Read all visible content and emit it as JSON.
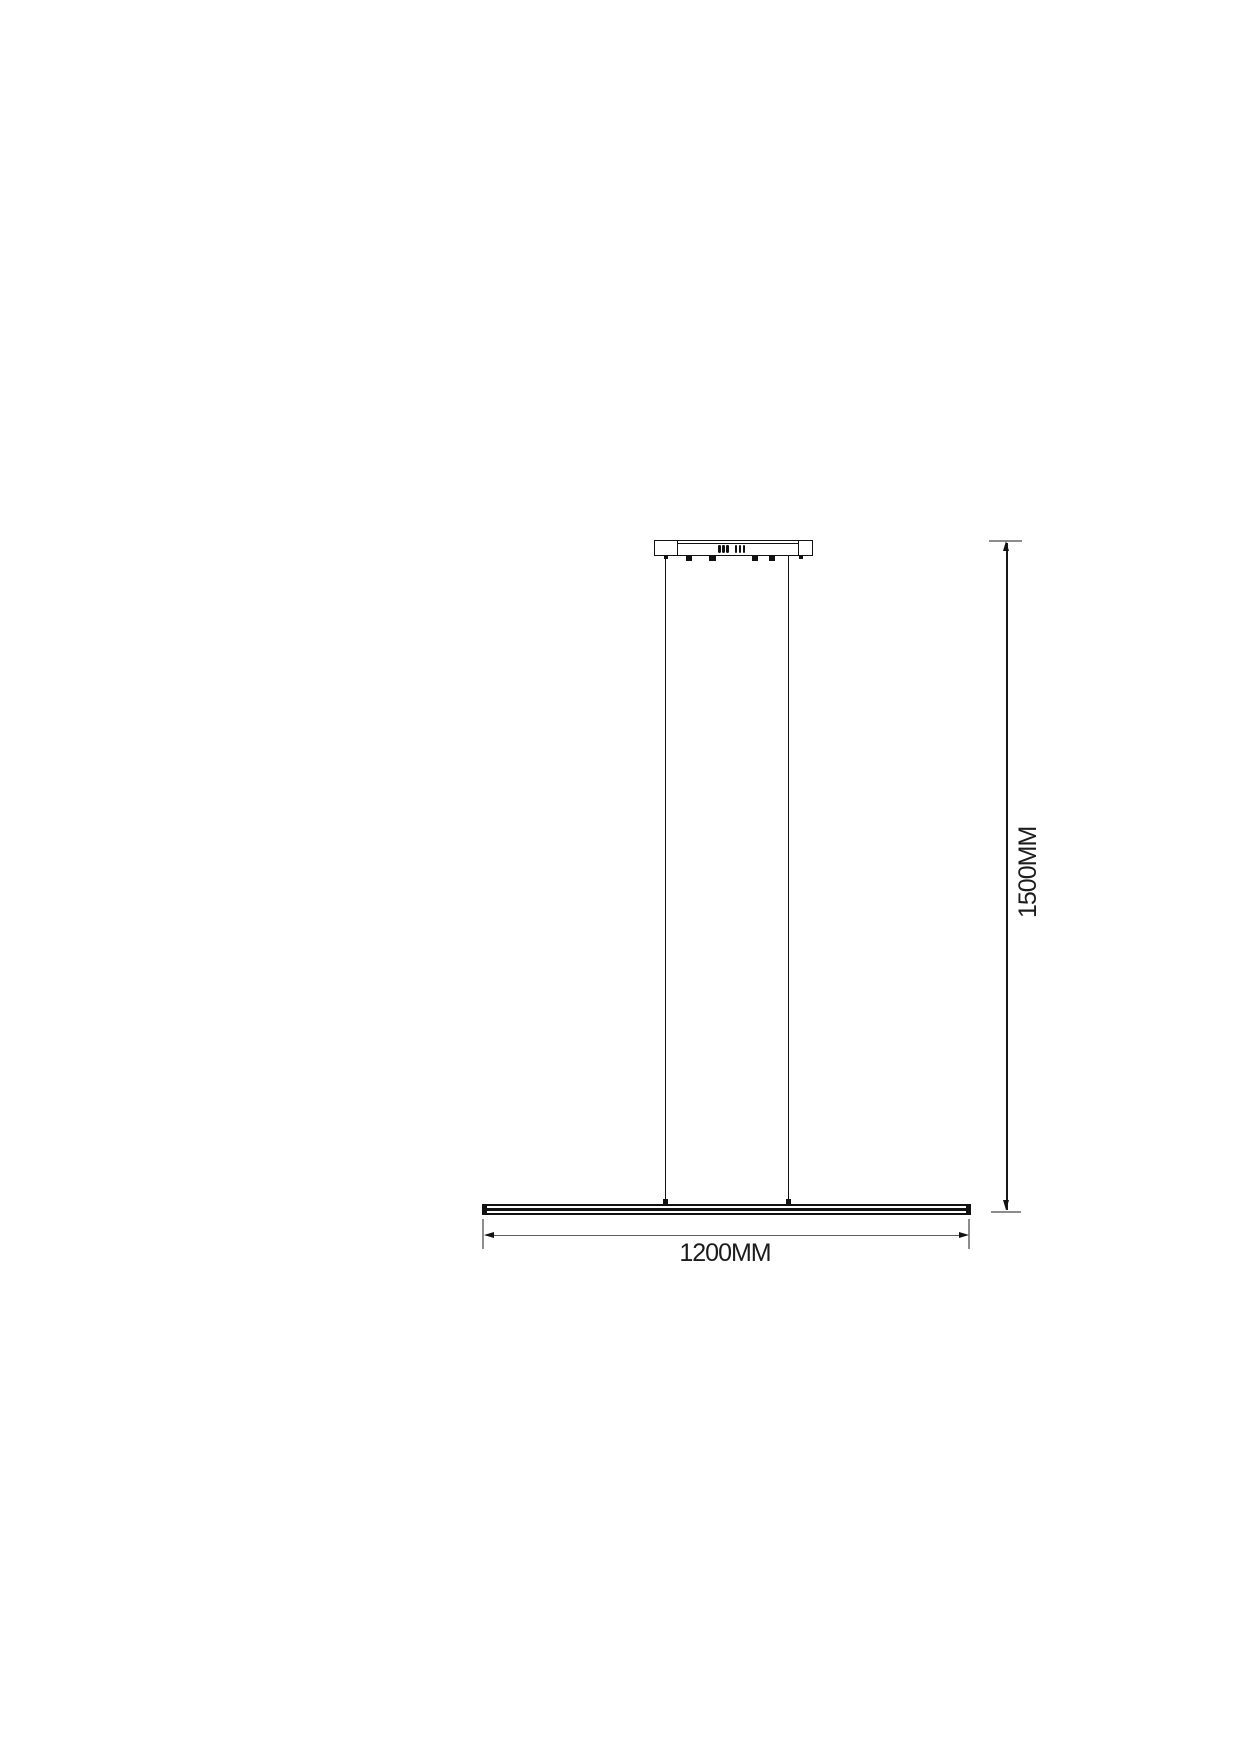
{
  "diagram": {
    "subject": "linear-pendant-light-dimension-drawing",
    "width_dimension_label": "1200MM",
    "height_dimension_label": "1500MM",
    "colors": {
      "outline": "#111111",
      "extension_line": "#8d8d8d",
      "dimension_line": "#606060",
      "text": "#1c1c1c",
      "background": "#ffffff"
    }
  }
}
